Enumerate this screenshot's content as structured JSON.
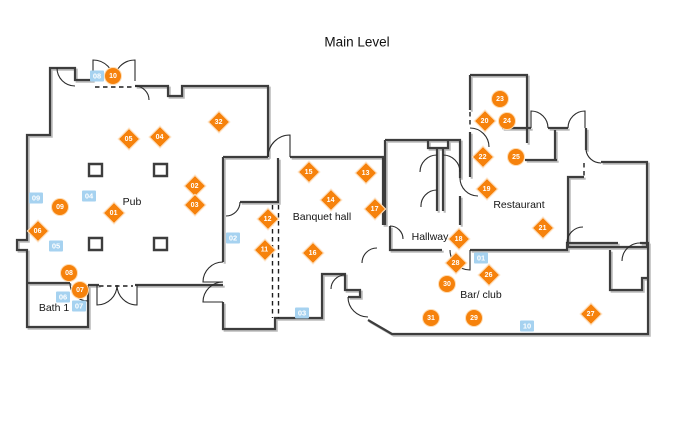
{
  "title": "Main Level",
  "colors": {
    "marker_orange": "#F6820C",
    "marker_blue": "#A6D2F0",
    "wall": "#3D3D3D",
    "wall_shadow": "#BCBCBC"
  },
  "rooms": [
    {
      "name": "Pub",
      "x": 132,
      "y": 202
    },
    {
      "name": "Bath 1",
      "x": 54,
      "y": 308
    },
    {
      "name": "Banquet hall",
      "x": 322,
      "y": 217
    },
    {
      "name": "Hallway",
      "x": 430,
      "y": 237
    },
    {
      "name": "Restaurant",
      "x": 519,
      "y": 205
    },
    {
      "name": "Bar/ club",
      "x": 481,
      "y": 295
    }
  ],
  "markers": {
    "diamonds": [
      {
        "label": "01",
        "x": 114,
        "y": 213
      },
      {
        "label": "02",
        "x": 195,
        "y": 186
      },
      {
        "label": "03",
        "x": 195,
        "y": 205
      },
      {
        "label": "04",
        "x": 160,
        "y": 137
      },
      {
        "label": "05",
        "x": 129,
        "y": 139
      },
      {
        "label": "06",
        "x": 38,
        "y": 231
      },
      {
        "label": "11",
        "x": 265,
        "y": 250
      },
      {
        "label": "12",
        "x": 268,
        "y": 219
      },
      {
        "label": "13",
        "x": 366,
        "y": 173
      },
      {
        "label": "14",
        "x": 331,
        "y": 200
      },
      {
        "label": "15",
        "x": 309,
        "y": 172
      },
      {
        "label": "16",
        "x": 313,
        "y": 253
      },
      {
        "label": "17",
        "x": 375,
        "y": 209
      },
      {
        "label": "18",
        "x": 459,
        "y": 239
      },
      {
        "label": "19",
        "x": 487,
        "y": 189
      },
      {
        "label": "20",
        "x": 485,
        "y": 121
      },
      {
        "label": "21",
        "x": 543,
        "y": 228
      },
      {
        "label": "22",
        "x": 483,
        "y": 157
      },
      {
        "label": "26",
        "x": 489,
        "y": 275
      },
      {
        "label": "27",
        "x": 591,
        "y": 314
      },
      {
        "label": "28",
        "x": 456,
        "y": 263
      },
      {
        "label": "32",
        "x": 219,
        "y": 122
      }
    ],
    "circles": [
      {
        "label": "07",
        "x": 80,
        "y": 290
      },
      {
        "label": "08",
        "x": 69,
        "y": 273
      },
      {
        "label": "09",
        "x": 60,
        "y": 207
      },
      {
        "label": "10",
        "x": 113,
        "y": 76
      },
      {
        "label": "23",
        "x": 500,
        "y": 99
      },
      {
        "label": "24",
        "x": 507,
        "y": 121
      },
      {
        "label": "25",
        "x": 516,
        "y": 157
      },
      {
        "label": "29",
        "x": 474,
        "y": 318
      },
      {
        "label": "30",
        "x": 447,
        "y": 284
      },
      {
        "label": "31",
        "x": 431,
        "y": 318
      }
    ],
    "squares": [
      {
        "label": "01",
        "x": 481,
        "y": 258
      },
      {
        "label": "02",
        "x": 233,
        "y": 238
      },
      {
        "label": "03",
        "x": 302,
        "y": 313
      },
      {
        "label": "04",
        "x": 89,
        "y": 196
      },
      {
        "label": "05",
        "x": 56,
        "y": 246
      },
      {
        "label": "06",
        "x": 63,
        "y": 297
      },
      {
        "label": "07",
        "x": 79,
        "y": 306
      },
      {
        "label": "08",
        "x": 97,
        "y": 76
      },
      {
        "label": "09",
        "x": 36,
        "y": 198
      },
      {
        "label": "10",
        "x": 527,
        "y": 326
      }
    ]
  }
}
